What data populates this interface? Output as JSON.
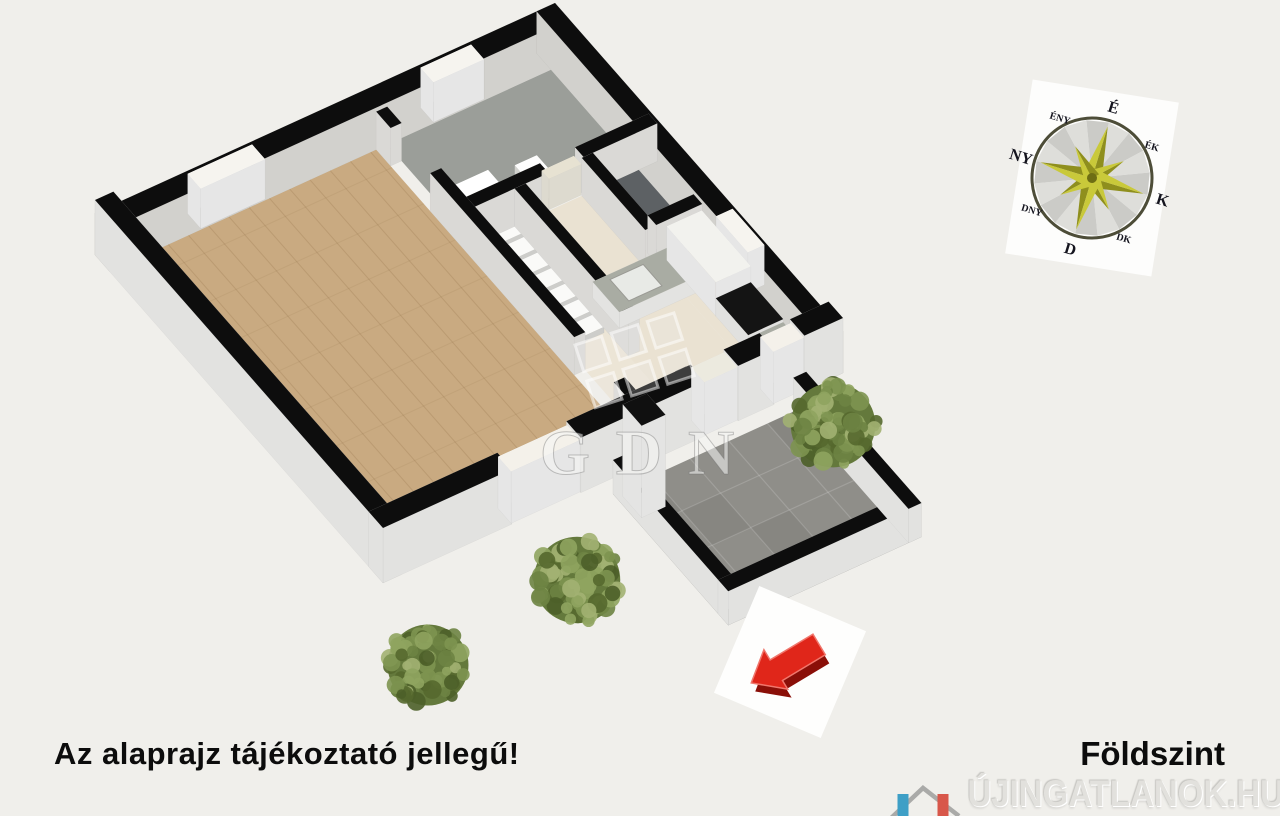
{
  "texts": {
    "disclaimer": "Az alaprajz tájékoztató jellegű!",
    "floor_label": "Földszint"
  },
  "watermarks": {
    "center_logo_text": "GDN",
    "corner_text": "ÚJINGATLANOK.HU"
  },
  "compass": {
    "labels": [
      "É",
      "ÉK",
      "K",
      "DK",
      "D",
      "DNY",
      "NY",
      "ÉNY"
    ]
  },
  "colors": {
    "background": "#f0efeb",
    "wall_top": "#0d0d0d",
    "wall_face": "#f2f1ee",
    "exterior_face": "#fbfbf9",
    "living_floor": "#c9aa81",
    "hall_floor": "#ece5d6",
    "bath_floor": "#9b9e99",
    "wc_floor": "#5d6164",
    "kitchen_floor": "#eae2d2",
    "counter_top": "#a9aca3",
    "range_top": "#141414",
    "terrace_floor": "#8f8e89",
    "bush_green": "#6f8444",
    "compass_star_light": "#c9c93a",
    "compass_star_dark": "#8f8f1d",
    "arrow_red": "#e0261a",
    "arrow_red_dark": "#8a0f08",
    "logo_blue": "#3e9fc6",
    "logo_red": "#d8574a"
  }
}
